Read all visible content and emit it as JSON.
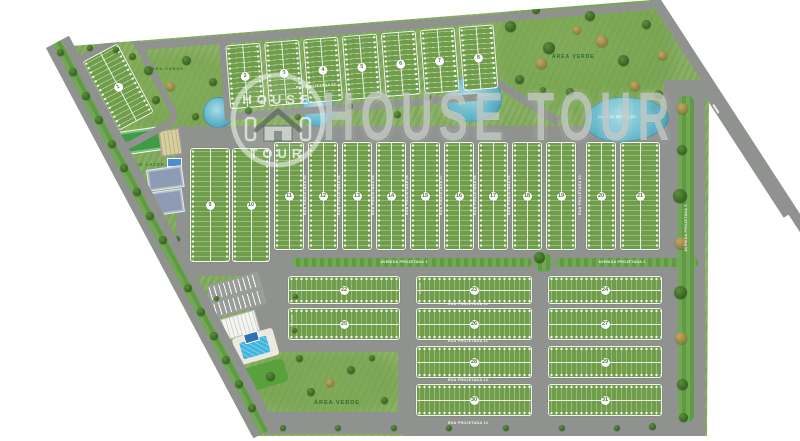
{
  "watermark": {
    "logo_top": "HOUSE",
    "logo_bottom": "TOUR",
    "big": "HOUSE TOUR"
  },
  "labels": {
    "area_verde_top": "ÁREA VERDE",
    "area_verde_left": "ÁREA VERDE",
    "area_verde_bottom": "ÁREA VERDE",
    "area_lazer": "ÁREA DE LAZER",
    "lake_right": "LAGO DE RETENÇÃO",
    "lake_center": "LAGO DE RETENÇÃO"
  },
  "lot_area_label": "250,00m²",
  "colors": {
    "grass": "#83ac5e",
    "road": "#8f928f",
    "block": "#6f9d4a",
    "water": "#5fb4ca",
    "median": "#67a349",
    "dark": "#33601f",
    "brown": "#8d7a3e",
    "pool": "#3fb4dd",
    "white": "#ffffff"
  },
  "road_labels": [
    {
      "text": "RUA PROJETADA 01",
      "x": 356,
      "y": 19,
      "r": -4.5,
      "m": false
    },
    {
      "text": "RUA PROJETADA 02",
      "x": 316,
      "y": 86,
      "r": -4.5,
      "m": false
    },
    {
      "text": "RUA PROJETADA 03",
      "x": 305,
      "y": 195,
      "r": -90,
      "m": false
    },
    {
      "text": "RUA PROJETADA 04",
      "x": 339,
      "y": 195,
      "r": -90,
      "m": false
    },
    {
      "text": "RUA PROJETADA 05",
      "x": 373,
      "y": 195,
      "r": -90,
      "m": false
    },
    {
      "text": "RUA PROJETADA 06",
      "x": 407,
      "y": 195,
      "r": -90,
      "m": false
    },
    {
      "text": "RUA PROJETADA 07",
      "x": 441,
      "y": 195,
      "r": -90,
      "m": false
    },
    {
      "text": "RUA PROJETADA 08",
      "x": 475,
      "y": 195,
      "r": -90,
      "m": false
    },
    {
      "text": "RUA PROJETADA 09",
      "x": 509,
      "y": 195,
      "r": -90,
      "m": false
    },
    {
      "text": "RUA PROJETADA 10",
      "x": 580,
      "y": 195,
      "r": -90,
      "m": false
    },
    {
      "text": "AVENIDA PROJETADA 1",
      "x": 404,
      "y": 262,
      "r": 0,
      "m": false
    },
    {
      "text": "AVENIDA PROJETADA 2",
      "x": 622,
      "y": 262,
      "r": 0,
      "m": false
    },
    {
      "text": "AVENIDA PROJETADA 3",
      "x": 686,
      "y": 228,
      "r": -90,
      "m": false
    },
    {
      "text": "AVENIDA PROJETADA 4",
      "x": 112,
      "y": 186,
      "r": 62,
      "m": false
    },
    {
      "text": "RUA PROJETADA 11",
      "x": 468,
      "y": 304,
      "r": 0,
      "m": false
    },
    {
      "text": "RUA PROJETADA 12",
      "x": 468,
      "y": 341,
      "r": 0,
      "m": false
    },
    {
      "text": "RUA PROJETADA 13",
      "x": 468,
      "y": 380,
      "r": 0,
      "m": false
    },
    {
      "text": "RUA PROJETADA 14",
      "x": 468,
      "y": 423,
      "r": 0,
      "m": false
    },
    {
      "text": "250,00m²",
      "x": 293,
      "y": 320,
      "r": -90,
      "m": true
    },
    {
      "text": "250,00m²",
      "x": 421,
      "y": 288,
      "r": -90,
      "m": true
    }
  ],
  "blocks": [
    {
      "n": 1,
      "g": "q1",
      "x": 0,
      "y": 0,
      "w": 38,
      "h": 76,
      "o": "v"
    },
    {
      "n": 2,
      "g": "top",
      "x": 6,
      "y": 16,
      "w": 33,
      "h": 62,
      "o": "v"
    },
    {
      "n": 3,
      "g": "top",
      "x": 45,
      "y": 16,
      "w": 33,
      "h": 62,
      "o": "v"
    },
    {
      "n": 4,
      "g": "top",
      "x": 84,
      "y": 16,
      "w": 33,
      "h": 62,
      "o": "v"
    },
    {
      "n": 5,
      "g": "top",
      "x": 123,
      "y": 16,
      "w": 33,
      "h": 62,
      "o": "v"
    },
    {
      "n": 6,
      "g": "top",
      "x": 162,
      "y": 16,
      "w": 33,
      "h": 62,
      "o": "v"
    },
    {
      "n": 7,
      "g": "top",
      "x": 201,
      "y": 16,
      "w": 33,
      "h": 62,
      "o": "v"
    },
    {
      "n": 8,
      "g": "top",
      "x": 240,
      "y": 16,
      "w": 33,
      "h": 62,
      "o": "v"
    },
    {
      "n": 9,
      "g": "main",
      "x": 190,
      "y": 148,
      "w": 38,
      "h": 112,
      "o": "v"
    },
    {
      "n": 10,
      "g": "main",
      "x": 232,
      "y": 148,
      "w": 36,
      "h": 112,
      "o": "v"
    },
    {
      "n": 11,
      "g": "main",
      "x": 274,
      "y": 142,
      "w": 28,
      "h": 106,
      "o": "v"
    },
    {
      "n": 12,
      "g": "main",
      "x": 308,
      "y": 142,
      "w": 28,
      "h": 106,
      "o": "v"
    },
    {
      "n": 13,
      "g": "main",
      "x": 342,
      "y": 142,
      "w": 28,
      "h": 106,
      "o": "v"
    },
    {
      "n": 14,
      "g": "main",
      "x": 376,
      "y": 142,
      "w": 28,
      "h": 106,
      "o": "v"
    },
    {
      "n": 15,
      "g": "main",
      "x": 410,
      "y": 142,
      "w": 28,
      "h": 106,
      "o": "v"
    },
    {
      "n": 16,
      "g": "main",
      "x": 444,
      "y": 142,
      "w": 28,
      "h": 106,
      "o": "v"
    },
    {
      "n": 17,
      "g": "main",
      "x": 478,
      "y": 142,
      "w": 28,
      "h": 106,
      "o": "v"
    },
    {
      "n": 18,
      "g": "main",
      "x": 512,
      "y": 142,
      "w": 28,
      "h": 106,
      "o": "v"
    },
    {
      "n": 19,
      "g": "main",
      "x": 546,
      "y": 142,
      "w": 28,
      "h": 106,
      "o": "v"
    },
    {
      "n": 20,
      "g": "main",
      "x": 586,
      "y": 142,
      "w": 28,
      "h": 106,
      "o": "v"
    },
    {
      "n": 21,
      "g": "main",
      "x": 620,
      "y": 142,
      "w": 38,
      "h": 106,
      "o": "v"
    },
    {
      "n": 22,
      "g": "main",
      "x": 288,
      "y": 276,
      "w": 110,
      "h": 26,
      "o": "h"
    },
    {
      "n": 23,
      "g": "main",
      "x": 416,
      "y": 276,
      "w": 114,
      "h": 26,
      "o": "h"
    },
    {
      "n": 24,
      "g": "main",
      "x": 548,
      "y": 276,
      "w": 112,
      "h": 26,
      "o": "h"
    },
    {
      "n": 25,
      "g": "main",
      "x": 288,
      "y": 308,
      "w": 110,
      "h": 30,
      "o": "h"
    },
    {
      "n": 26,
      "g": "main",
      "x": 416,
      "y": 308,
      "w": 114,
      "h": 30,
      "o": "h"
    },
    {
      "n": 27,
      "g": "main",
      "x": 548,
      "y": 308,
      "w": 112,
      "h": 30,
      "o": "h"
    },
    {
      "n": 28,
      "g": "main",
      "x": 416,
      "y": 346,
      "w": 114,
      "h": 30,
      "o": "h"
    },
    {
      "n": 29,
      "g": "main",
      "x": 548,
      "y": 346,
      "w": 112,
      "h": 30,
      "o": "h"
    },
    {
      "n": 30,
      "g": "main",
      "x": 416,
      "y": 384,
      "w": 114,
      "h": 30,
      "o": "h"
    },
    {
      "n": 31,
      "g": "main",
      "x": 548,
      "y": 384,
      "w": 112,
      "h": 30,
      "o": "h"
    }
  ],
  "trees": [
    {
      "x": 510,
      "y": 26,
      "s": 11,
      "t": "d"
    },
    {
      "x": 549,
      "y": 48,
      "s": 12,
      "t": "d"
    },
    {
      "x": 590,
      "y": 16,
      "s": 10,
      "t": "d"
    },
    {
      "x": 623,
      "y": 60,
      "s": 11,
      "t": "d"
    },
    {
      "x": 519,
      "y": 79,
      "s": 9,
      "t": "d"
    },
    {
      "x": 646,
      "y": 24,
      "s": 9,
      "t": "d"
    },
    {
      "x": 658,
      "y": 94,
      "s": 9,
      "t": "d"
    },
    {
      "x": 570,
      "y": 92,
      "s": 8,
      "t": "d"
    },
    {
      "x": 536,
      "y": 10,
      "s": 8,
      "t": "d"
    },
    {
      "x": 541,
      "y": 63,
      "s": 11,
      "t": "b"
    },
    {
      "x": 602,
      "y": 41,
      "s": 12,
      "t": "b"
    },
    {
      "x": 635,
      "y": 86,
      "s": 10,
      "t": "b"
    },
    {
      "x": 577,
      "y": 30,
      "s": 8,
      "t": "b"
    },
    {
      "x": 662,
      "y": 55,
      "s": 9,
      "t": "b"
    },
    {
      "x": 248,
      "y": 110,
      "s": 7,
      "t": "d"
    },
    {
      "x": 298,
      "y": 117,
      "s": 6,
      "t": "d"
    },
    {
      "x": 350,
      "y": 106,
      "s": 6,
      "t": "d"
    },
    {
      "x": 397,
      "y": 114,
      "s": 7,
      "t": "d"
    },
    {
      "x": 428,
      "y": 97,
      "s": 6,
      "t": "d"
    },
    {
      "x": 543,
      "y": 90,
      "s": 6,
      "t": "d"
    },
    {
      "x": 148,
      "y": 70,
      "s": 9,
      "t": "d"
    },
    {
      "x": 186,
      "y": 60,
      "s": 9,
      "t": "d"
    },
    {
      "x": 213,
      "y": 82,
      "s": 8,
      "t": "d"
    },
    {
      "x": 156,
      "y": 100,
      "s": 8,
      "t": "d"
    },
    {
      "x": 195,
      "y": 116,
      "s": 7,
      "t": "d"
    },
    {
      "x": 132,
      "y": 56,
      "s": 7,
      "t": "d"
    },
    {
      "x": 170,
      "y": 86,
      "s": 9,
      "t": "b"
    },
    {
      "x": 60,
      "y": 48,
      "s": 7,
      "t": "b"
    },
    {
      "x": 90,
      "y": 48,
      "s": 6,
      "t": "d"
    },
    {
      "x": 116,
      "y": 50,
      "s": 6,
      "t": "d"
    },
    {
      "x": 270,
      "y": 376,
      "s": 9,
      "t": "d"
    },
    {
      "x": 311,
      "y": 392,
      "s": 8,
      "t": "d"
    },
    {
      "x": 351,
      "y": 370,
      "s": 8,
      "t": "d"
    },
    {
      "x": 384,
      "y": 400,
      "s": 7,
      "t": "d"
    },
    {
      "x": 299,
      "y": 358,
      "s": 7,
      "t": "d"
    },
    {
      "x": 260,
      "y": 406,
      "s": 7,
      "t": "d"
    },
    {
      "x": 372,
      "y": 358,
      "s": 6,
      "t": "d"
    },
    {
      "x": 330,
      "y": 383,
      "s": 8,
      "t": "b"
    },
    {
      "x": 166,
      "y": 226,
      "s": 6,
      "t": "d"
    },
    {
      "x": 177,
      "y": 239,
      "s": 6,
      "t": "d"
    },
    {
      "x": 216,
      "y": 298,
      "s": 5,
      "t": "d"
    },
    {
      "x": 295,
      "y": 296,
      "s": 5,
      "t": "d"
    },
    {
      "x": 238,
      "y": 370,
      "s": 6,
      "t": "d"
    },
    {
      "x": 294,
      "y": 330,
      "s": 5,
      "t": "d"
    },
    {
      "x": 283,
      "y": 428,
      "s": 6,
      "t": "d"
    },
    {
      "x": 338,
      "y": 428,
      "s": 6,
      "t": "d"
    },
    {
      "x": 394,
      "y": 428,
      "s": 6,
      "t": "d"
    },
    {
      "x": 449,
      "y": 428,
      "s": 6,
      "t": "d"
    },
    {
      "x": 506,
      "y": 428,
      "s": 6,
      "t": "d"
    },
    {
      "x": 562,
      "y": 428,
      "s": 6,
      "t": "d"
    },
    {
      "x": 617,
      "y": 428,
      "s": 6,
      "t": "d"
    },
    {
      "x": 652,
      "y": 426,
      "s": 7,
      "t": "d"
    },
    {
      "x": 682,
      "y": 108,
      "s": 11,
      "t": "b"
    },
    {
      "x": 682,
      "y": 150,
      "s": 10,
      "t": "d"
    },
    {
      "x": 680,
      "y": 196,
      "s": 14,
      "t": "d"
    },
    {
      "x": 681,
      "y": 243,
      "s": 12,
      "t": "b"
    },
    {
      "x": 680,
      "y": 292,
      "s": 13,
      "t": "d"
    },
    {
      "x": 681,
      "y": 338,
      "s": 12,
      "t": "b"
    },
    {
      "x": 682,
      "y": 384,
      "s": 11,
      "t": "d"
    },
    {
      "x": 683,
      "y": 417,
      "s": 9,
      "t": "d"
    },
    {
      "x": 539,
      "y": 257,
      "s": 11,
      "t": "d"
    }
  ],
  "road_trees": [
    {
      "x": 73,
      "y": 72,
      "s": 8,
      "t": "d"
    },
    {
      "x": 86,
      "y": 96,
      "s": 8,
      "t": "d"
    },
    {
      "x": 99,
      "y": 120,
      "s": 8,
      "t": "d"
    },
    {
      "x": 112,
      "y": 144,
      "s": 8,
      "t": "d"
    },
    {
      "x": 124,
      "y": 168,
      "s": 8,
      "t": "d"
    },
    {
      "x": 137,
      "y": 192,
      "s": 8,
      "t": "d"
    },
    {
      "x": 150,
      "y": 216,
      "s": 8,
      "t": "d"
    },
    {
      "x": 163,
      "y": 240,
      "s": 8,
      "t": "d"
    },
    {
      "x": 188,
      "y": 288,
      "s": 8,
      "t": "d"
    },
    {
      "x": 201,
      "y": 312,
      "s": 8,
      "t": "d"
    },
    {
      "x": 214,
      "y": 336,
      "s": 8,
      "t": "d"
    },
    {
      "x": 226,
      "y": 360,
      "s": 8,
      "t": "d"
    },
    {
      "x": 239,
      "y": 384,
      "s": 8,
      "t": "d"
    },
    {
      "x": 252,
      "y": 408,
      "s": 8,
      "t": "d"
    },
    {
      "x": 60,
      "y": 52,
      "s": 7,
      "t": "d"
    }
  ]
}
